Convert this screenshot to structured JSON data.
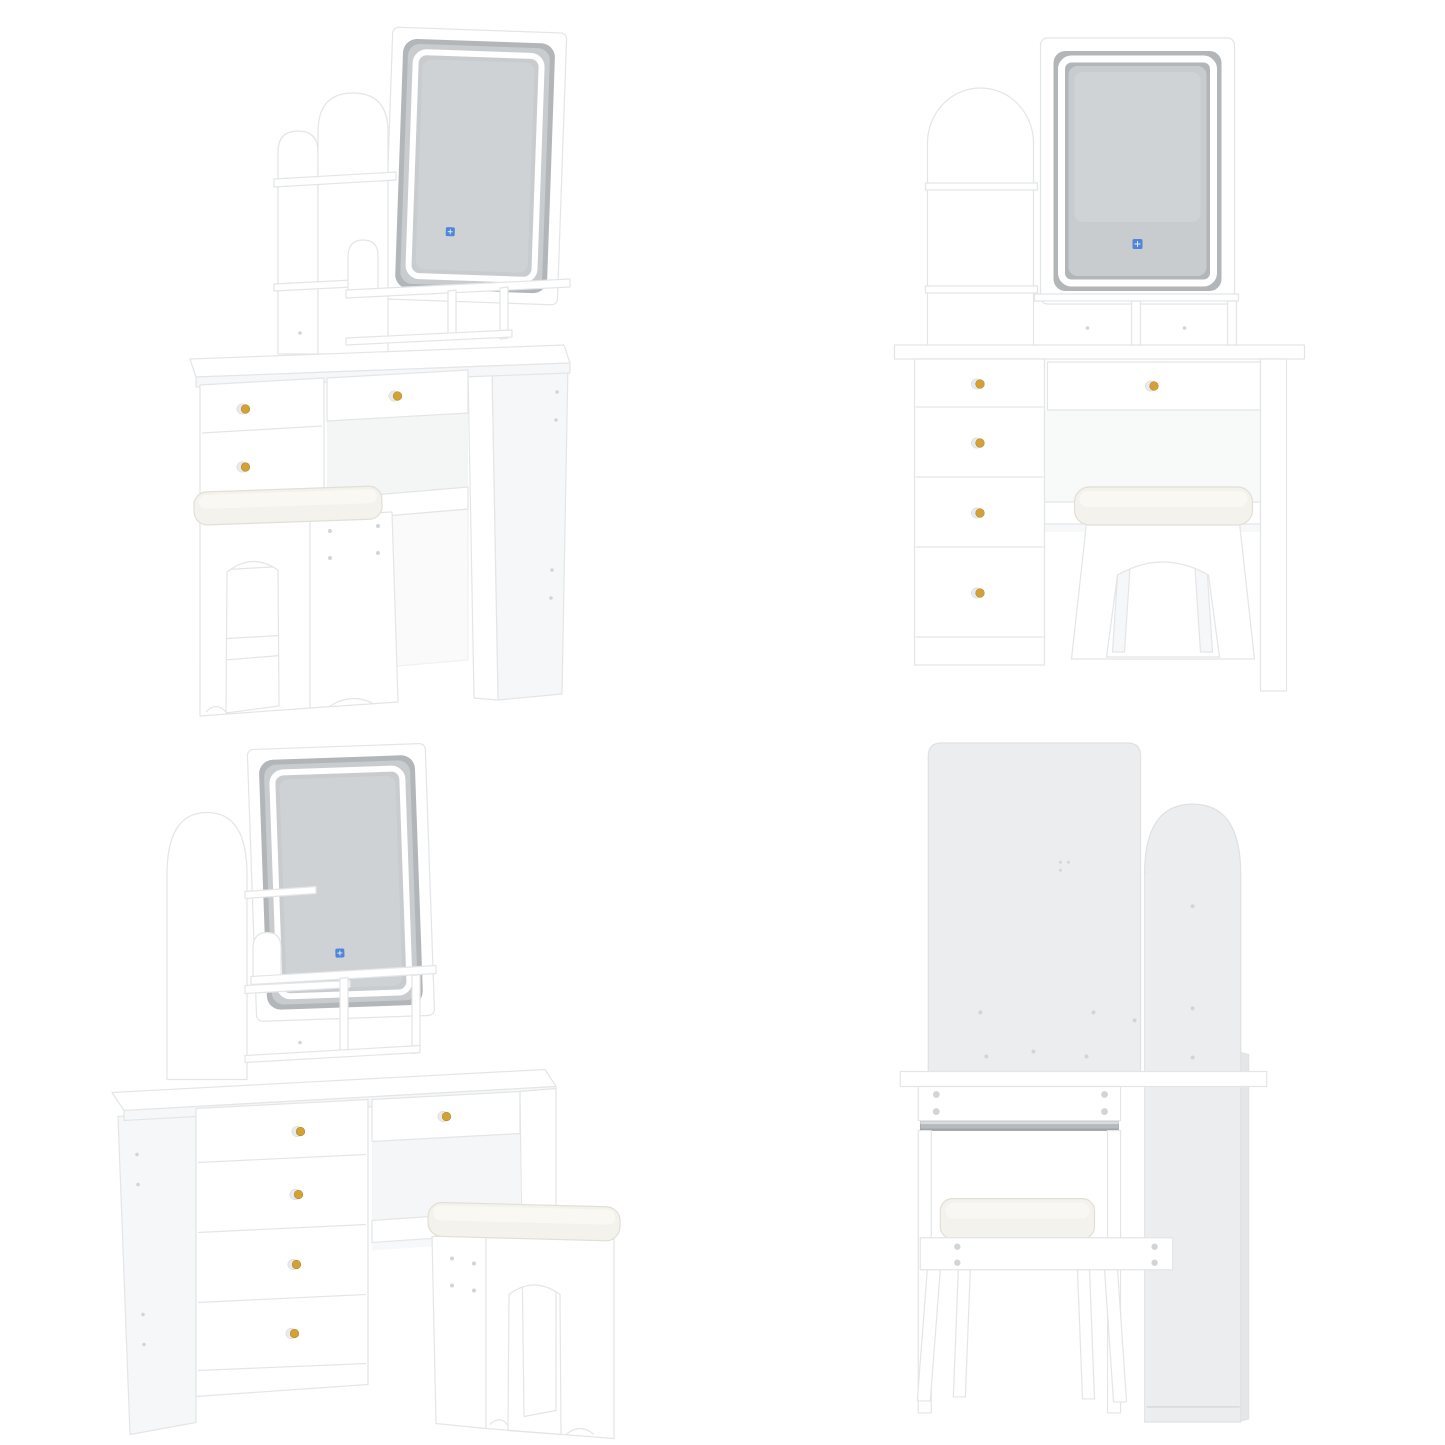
{
  "page": {
    "background": "#ffffff",
    "layout": "2x2-product-photo-grid"
  },
  "subject": {
    "description": "White vanity dressing table set with rectangular LED touch mirror, arched open shelves, drawers with gold knobs, and a matching cushioned stool",
    "views_count": 4
  },
  "views": [
    {
      "id": "front-left-angle",
      "label": "Vanity table with LED mirror and stool, angled view from front-left",
      "mirror_touch_icon": true,
      "visible_knobs": 3
    },
    {
      "id": "front",
      "label": "Vanity table with LED mirror and stool, front view",
      "mirror_touch_icon": true,
      "visible_knobs": 5
    },
    {
      "id": "front-right-angle",
      "label": "Vanity table with LED mirror and stool, angled view from front-right",
      "mirror_touch_icon": true,
      "visible_knobs": 5
    },
    {
      "id": "back",
      "label": "Vanity table and stool, back view with cam fittings and drawer slide rail",
      "mirror_touch_icon": false,
      "visible_knobs": 0
    }
  ],
  "colors": {
    "white_main": "#ffffff",
    "white_soft": "#f6f7f8",
    "white_shade": "#eceeef",
    "edge": "#e3e5e7",
    "edge_dark": "#cfd3d5",
    "mirror_glass": "#c8cccf",
    "mirror_glass_edge": "#b2b6b9",
    "mirror_glass_light": "#d6dadc",
    "led_white": "#ffffff",
    "touch_blue": "#4f86d9",
    "knob_gold": "#d3a237",
    "knob_gold_dark": "#b8882a",
    "knob_base": "#e9eaeb",
    "cushion": "#f4f2ec",
    "cushion_hi": "#fbfaf6",
    "cushion_edge": "#e2dfd6",
    "back_panel": "#ecedef",
    "back_panel_dark": "#e4e6e8",
    "back_edge": "#dfe1e3",
    "metal_rail": "#b6babd",
    "metal_rail_dark": "#9aa0a4",
    "metal_rail_light": "#d9dcde",
    "screw": "#d2d5d7"
  }
}
